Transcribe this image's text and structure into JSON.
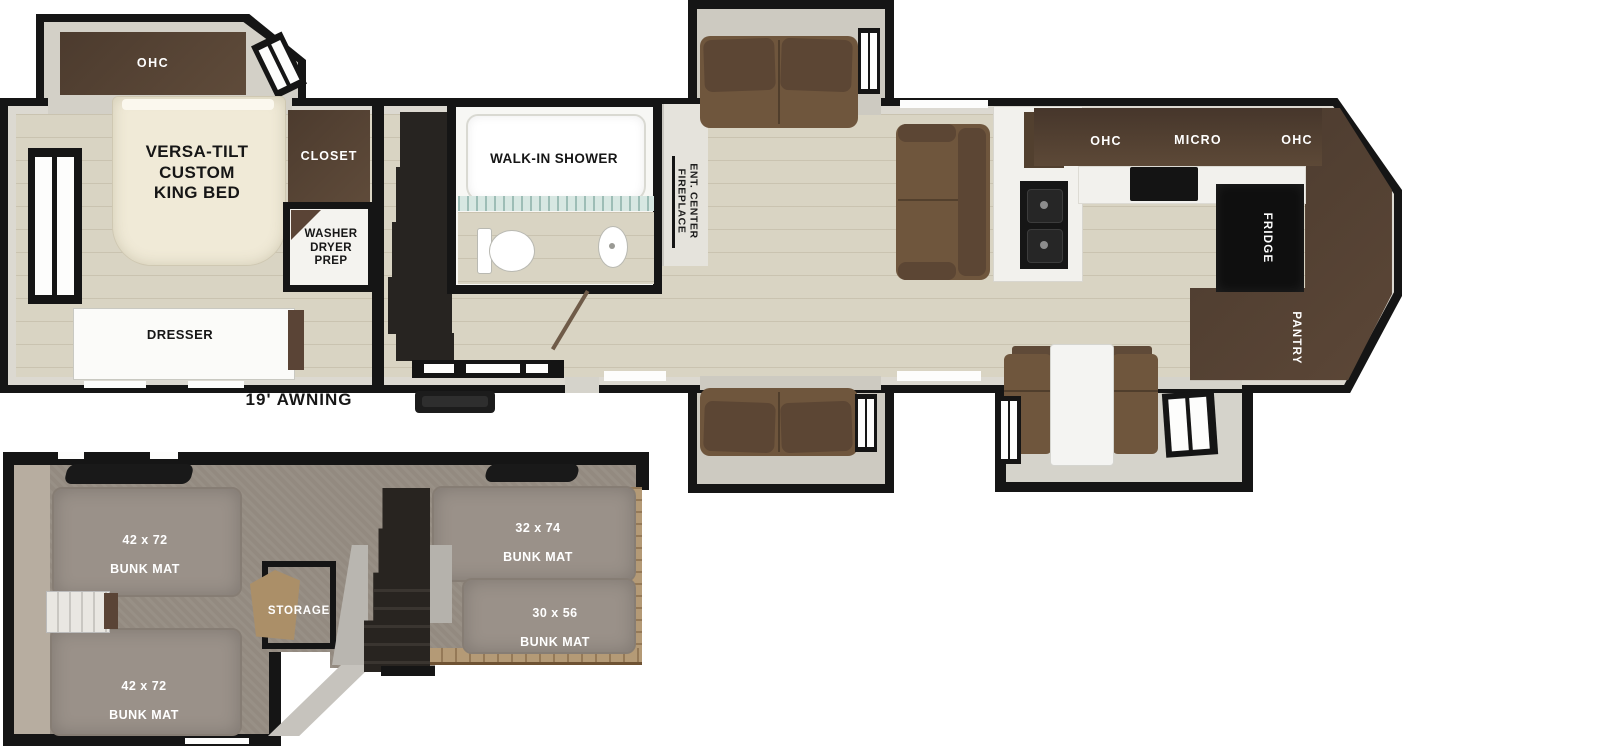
{
  "main_floor": {
    "awning": "19' AWNING",
    "bedroom": {
      "ohc": "OHC",
      "bed": "VERSA-TILT\nCUSTOM\nKING BED",
      "closet": "CLOSET",
      "washer_dryer": "WASHER\nDRYER\nPREP",
      "dresser": "DRESSER"
    },
    "bathroom": {
      "shower": "WALK-IN SHOWER"
    },
    "living": {
      "ent_center": "ENT. CENTER\nFIREPLACE"
    },
    "kitchen": {
      "ohc_left": "OHC",
      "micro": "MICRO",
      "ohc_right": "OHC",
      "fridge": "FRIDGE",
      "pantry": "PANTRY"
    }
  },
  "loft": {
    "storage": "STORAGE",
    "mats": [
      {
        "size": "42 x 72",
        "label": "BUNK MAT"
      },
      {
        "size": "42 x 72",
        "label": "BUNK MAT"
      },
      {
        "size": "32 x 74",
        "label": "BUNK MAT"
      },
      {
        "size": "30 x 56",
        "label": "BUNK MAT"
      }
    ]
  },
  "colors": {
    "wall": "#151515",
    "floor_wood": "#d9d4c3",
    "cabinet_brown": "#4c3b2e",
    "sofa_brown": "#6f563d",
    "bed_cream": "#f0ead7",
    "bunk_mat": "#9a9189",
    "carpet": "#938a80",
    "shower_glass": "#d7e7e2"
  }
}
